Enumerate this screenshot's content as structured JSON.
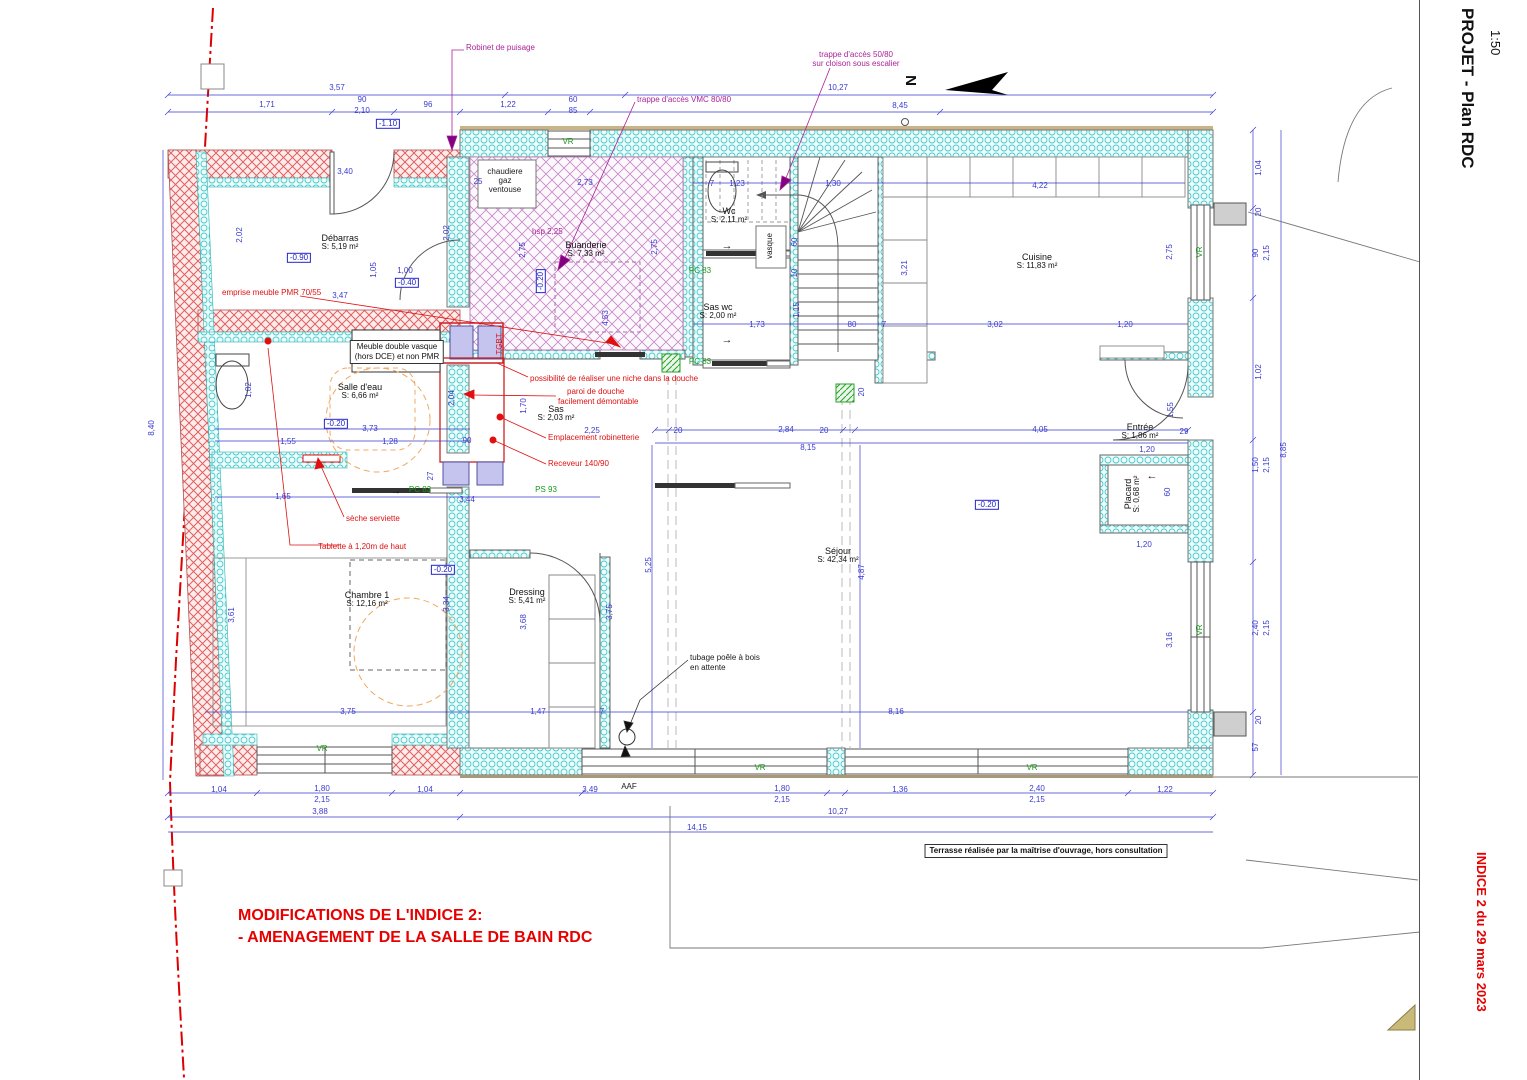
{
  "meta": {
    "title": "PROJET - Plan RDC",
    "scale": "1:50",
    "revision": "INDICE 2 du 29 mars 2023",
    "north": "N"
  },
  "notes": {
    "modif1": "MODIFICATIONS DE L'INDICE 2:",
    "modif2": "- AMENAGEMENT DE LA SALLE DE BAIN RDC",
    "terrasse": "Terrasse réalisée par la maîtrise d'ouvrage, hors consultation",
    "meuble1": "Meuble double vasque",
    "meuble2": "(hors DCE) et non PMR"
  },
  "rooms": [
    {
      "name": "Débarras",
      "area": "S: 5,19 m²",
      "x": 340,
      "y": 243
    },
    {
      "name": "Buanderie",
      "area": "S: 7,33 m²",
      "x": 586,
      "y": 250
    },
    {
      "name": "Wc",
      "area": "S: 2,11 m²",
      "x": 729,
      "y": 216
    },
    {
      "name": "Sas wc",
      "area": "S: 2,00 m²",
      "x": 718,
      "y": 312
    },
    {
      "name": "Cuisine",
      "area": "S: 11,83 m²",
      "x": 1037,
      "y": 262
    },
    {
      "name": "Salle d'eau",
      "area": "S: 6,66 m²",
      "x": 360,
      "y": 392
    },
    {
      "name": "Sas",
      "area": "S: 2,03 m²",
      "x": 556,
      "y": 414
    },
    {
      "name": "Entrée",
      "area": "S: 1,86 m²",
      "x": 1140,
      "y": 432
    },
    {
      "name": "Placard",
      "area": "S: 0,68 m²",
      "x": 1133,
      "y": 494,
      "v": 1
    },
    {
      "name": "Chambre 1",
      "area": "S: 12,16 m²",
      "x": 367,
      "y": 600
    },
    {
      "name": "Dressing",
      "area": "S: 5,41 m²",
      "x": 527,
      "y": 597
    },
    {
      "name": "Séjour",
      "area": "S: 42,34 m²",
      "x": 838,
      "y": 556
    }
  ],
  "levels": [
    {
      "t": "-1.10",
      "x": 388,
      "y": 124
    },
    {
      "t": "-0.90",
      "x": 299,
      "y": 258
    },
    {
      "t": "-0.40",
      "x": 407,
      "y": 283
    },
    {
      "t": "-0.20",
      "x": 541,
      "y": 281,
      "v": 1
    },
    {
      "t": "-0.20",
      "x": 336,
      "y": 424
    },
    {
      "t": "-0.20",
      "x": 443,
      "y": 570
    },
    {
      "t": "-0.20",
      "x": 987,
      "y": 505
    }
  ],
  "openings": [
    {
      "t": "VR",
      "x": 568,
      "y": 142
    },
    {
      "t": "VR",
      "x": 1200,
      "y": 252,
      "v": 1
    },
    {
      "t": "VR",
      "x": 1200,
      "y": 630,
      "v": 1
    },
    {
      "t": "VR",
      "x": 322,
      "y": 749
    },
    {
      "t": "VR",
      "x": 760,
      "y": 768
    },
    {
      "t": "VR",
      "x": 1032,
      "y": 768
    },
    {
      "t": "PC 83",
      "x": 700,
      "y": 271
    },
    {
      "t": "PC 83",
      "x": 700,
      "y": 362
    },
    {
      "t": "PC 83",
      "x": 420,
      "y": 490
    },
    {
      "t": "PS 93",
      "x": 546,
      "y": 490
    }
  ],
  "annotations": {
    "red": [
      {
        "t": "emprise meuble PMR 70/55",
        "x": 222,
        "y": 293,
        "anchor": "left"
      },
      {
        "t": "possibilité de réaliser une niche dans la douche",
        "x": 530,
        "y": 379,
        "anchor": "left"
      },
      {
        "t": "paroi de douche",
        "x": 567,
        "y": 392,
        "anchor": "left"
      },
      {
        "t": "facilement démontable",
        "x": 558,
        "y": 402,
        "anchor": "left"
      },
      {
        "t": "Emplacement robinetterie",
        "x": 548,
        "y": 438,
        "anchor": "left"
      },
      {
        "t": "Receveur 140/90",
        "x": 548,
        "y": 464,
        "anchor": "left"
      },
      {
        "t": "sèche serviette",
        "x": 346,
        "y": 519,
        "anchor": "left"
      },
      {
        "t": "Tablette à 1,20m de haut",
        "x": 318,
        "y": 547,
        "anchor": "left"
      },
      {
        "t": "TGBT",
        "x": 500,
        "y": 344,
        "v": 1
      }
    ],
    "magenta": [
      {
        "t": "Robinet de puisage",
        "x": 466,
        "y": 48,
        "anchor": "left"
      },
      {
        "t": "trappe d'accès VMC 80/80",
        "x": 637,
        "y": 100,
        "anchor": "left"
      },
      {
        "t": "trappe d'accès 50/80",
        "x": 856,
        "y": 55
      },
      {
        "t": "sur cloison sous escalier",
        "x": 856,
        "y": 64
      },
      {
        "t": "hsp 2,25",
        "x": 532,
        "y": 232,
        "anchor": "left"
      }
    ],
    "black": [
      {
        "t": "chaudiere",
        "x": 505,
        "y": 172
      },
      {
        "t": "gaz",
        "x": 505,
        "y": 181
      },
      {
        "t": "ventouse",
        "x": 505,
        "y": 190
      },
      {
        "t": "vasque",
        "x": 770,
        "y": 246,
        "v": 1
      },
      {
        "t": "tubage poêle à bois",
        "x": 690,
        "y": 658,
        "anchor": "left"
      },
      {
        "t": "en attente",
        "x": 690,
        "y": 668,
        "anchor": "left"
      },
      {
        "t": "AAF",
        "x": 629,
        "y": 787
      }
    ],
    "arrows": [
      {
        "t": "→",
        "x": 727,
        "y": 247
      },
      {
        "t": "→",
        "x": 727,
        "y": 341
      },
      {
        "t": "→",
        "x": 396,
        "y": 492
      },
      {
        "t": "←",
        "x": 1152,
        "y": 477
      }
    ]
  },
  "dims": [
    {
      "t": "3,57",
      "x": 337,
      "y": 88
    },
    {
      "t": "1,71",
      "x": 267,
      "y": 105
    },
    {
      "t": "90",
      "x": 362,
      "y": 100
    },
    {
      "t": "2,10",
      "x": 362,
      "y": 111
    },
    {
      "t": "96",
      "x": 428,
      "y": 105
    },
    {
      "t": "1,22",
      "x": 508,
      "y": 105
    },
    {
      "t": "60",
      "x": 573,
      "y": 100
    },
    {
      "t": "85",
      "x": 573,
      "y": 111
    },
    {
      "t": "10,27",
      "x": 838,
      "y": 88
    },
    {
      "t": "8,45",
      "x": 900,
      "y": 106
    },
    {
      "t": "25",
      "x": 478,
      "y": 182
    },
    {
      "t": "2,73",
      "x": 585,
      "y": 183
    },
    {
      "t": "3,40",
      "x": 345,
      "y": 172
    },
    {
      "t": "1,23",
      "x": 737,
      "y": 184
    },
    {
      "t": "7",
      "x": 712,
      "y": 184
    },
    {
      "t": "1,30",
      "x": 833,
      "y": 184
    },
    {
      "t": "4,22",
      "x": 1040,
      "y": 186
    },
    {
      "t": "1,04",
      "x": 1259,
      "y": 168,
      "v": 1
    },
    {
      "t": "20",
      "x": 1259,
      "y": 212,
      "v": 1
    },
    {
      "t": "2,02",
      "x": 240,
      "y": 235,
      "v": 1
    },
    {
      "t": "2,02",
      "x": 447,
      "y": 233,
      "v": 1
    },
    {
      "t": "2,75",
      "x": 523,
      "y": 250,
      "v": 1
    },
    {
      "t": "2,75",
      "x": 655,
      "y": 247,
      "v": 1
    },
    {
      "t": "2,75",
      "x": 1170,
      "y": 252,
      "v": 1
    },
    {
      "t": "90",
      "x": 1256,
      "y": 253,
      "v": 1
    },
    {
      "t": "2,15",
      "x": 1267,
      "y": 253,
      "v": 1
    },
    {
      "t": "1,05",
      "x": 374,
      "y": 270,
      "v": 1
    },
    {
      "t": "1,00",
      "x": 405,
      "y": 271
    },
    {
      "t": "3,47",
      "x": 340,
      "y": 296
    },
    {
      "t": "3,21",
      "x": 905,
      "y": 268,
      "v": 1
    },
    {
      "t": "4,53",
      "x": 606,
      "y": 318,
      "v": 1
    },
    {
      "t": "1,15",
      "x": 797,
      "y": 310,
      "v": 1
    },
    {
      "t": "60",
      "x": 795,
      "y": 242,
      "v": 1
    },
    {
      "t": "10",
      "x": 795,
      "y": 273,
      "v": 1
    },
    {
      "t": "1,73",
      "x": 757,
      "y": 325
    },
    {
      "t": "80",
      "x": 852,
      "y": 325
    },
    {
      "t": "7",
      "x": 884,
      "y": 325
    },
    {
      "t": "3,02",
      "x": 995,
      "y": 325
    },
    {
      "t": "1,20",
      "x": 1125,
      "y": 325
    },
    {
      "t": "1,02",
      "x": 1259,
      "y": 372,
      "v": 1
    },
    {
      "t": "1,82",
      "x": 249,
      "y": 390,
      "v": 1
    },
    {
      "t": "2,04",
      "x": 452,
      "y": 398,
      "v": 1
    },
    {
      "t": "1,70",
      "x": 524,
      "y": 406,
      "v": 1
    },
    {
      "t": "2,25",
      "x": 592,
      "y": 431
    },
    {
      "t": "3,73",
      "x": 370,
      "y": 429
    },
    {
      "t": "1,28",
      "x": 390,
      "y": 442
    },
    {
      "t": "1,55",
      "x": 288,
      "y": 442
    },
    {
      "t": "90",
      "x": 467,
      "y": 441
    },
    {
      "t": "2,84",
      "x": 786,
      "y": 430
    },
    {
      "t": "20",
      "x": 678,
      "y": 431
    },
    {
      "t": "20",
      "x": 824,
      "y": 431
    },
    {
      "t": "4,05",
      "x": 1040,
      "y": 430
    },
    {
      "t": "8,15",
      "x": 808,
      "y": 448
    },
    {
      "t": "1,55",
      "x": 1171,
      "y": 410,
      "v": 1
    },
    {
      "t": "29",
      "x": 1184,
      "y": 432
    },
    {
      "t": "1,20",
      "x": 1147,
      "y": 450
    },
    {
      "t": "60",
      "x": 1168,
      "y": 492,
      "v": 1
    },
    {
      "t": "1,20",
      "x": 1144,
      "y": 545
    },
    {
      "t": "1,50",
      "x": 1256,
      "y": 465,
      "v": 1
    },
    {
      "t": "2,15",
      "x": 1267,
      "y": 465,
      "v": 1
    },
    {
      "t": "8,85",
      "x": 1284,
      "y": 450,
      "v": 1
    },
    {
      "t": "8,40",
      "x": 152,
      "y": 428,
      "v": 1
    },
    {
      "t": "1,65",
      "x": 283,
      "y": 497
    },
    {
      "t": "27",
      "x": 431,
      "y": 476,
      "v": 1
    },
    {
      "t": "3,44",
      "x": 467,
      "y": 500
    },
    {
      "t": "5,25",
      "x": 649,
      "y": 565,
      "v": 1
    },
    {
      "t": "4,87",
      "x": 862,
      "y": 572,
      "v": 1
    },
    {
      "t": "3,61",
      "x": 232,
      "y": 615,
      "v": 1
    },
    {
      "t": "3,34",
      "x": 447,
      "y": 604,
      "v": 1
    },
    {
      "t": "3,68",
      "x": 524,
      "y": 622,
      "v": 1
    },
    {
      "t": "3,75",
      "x": 610,
      "y": 612,
      "v": 1
    },
    {
      "t": "3,16",
      "x": 1170,
      "y": 640,
      "v": 1
    },
    {
      "t": "20",
      "x": 862,
      "y": 392,
      "v": 1
    },
    {
      "t": "2,40",
      "x": 1256,
      "y": 628,
      "v": 1
    },
    {
      "t": "2,15",
      "x": 1267,
      "y": 628,
      "v": 1
    },
    {
      "t": "3,75",
      "x": 348,
      "y": 712
    },
    {
      "t": "1,47",
      "x": 538,
      "y": 712
    },
    {
      "t": "7",
      "x": 602,
      "y": 712
    },
    {
      "t": "8,16",
      "x": 896,
      "y": 712
    },
    {
      "t": "20",
      "x": 1259,
      "y": 720,
      "v": 1
    },
    {
      "t": "57",
      "x": 1256,
      "y": 747,
      "v": 1
    },
    {
      "t": "1,04",
      "x": 219,
      "y": 790
    },
    {
      "t": "1,80",
      "x": 322,
      "y": 789
    },
    {
      "t": "2,15",
      "x": 322,
      "y": 800
    },
    {
      "t": "1,04",
      "x": 425,
      "y": 790
    },
    {
      "t": "3,49",
      "x": 590,
      "y": 790
    },
    {
      "t": "1,80",
      "x": 782,
      "y": 789
    },
    {
      "t": "2,15",
      "x": 782,
      "y": 800
    },
    {
      "t": "1,36",
      "x": 900,
      "y": 790
    },
    {
      "t": "2,40",
      "x": 1037,
      "y": 789
    },
    {
      "t": "2,15",
      "x": 1037,
      "y": 800
    },
    {
      "t": "1,22",
      "x": 1165,
      "y": 790
    },
    {
      "t": "3,88",
      "x": 320,
      "y": 812
    },
    {
      "t": "10,27",
      "x": 838,
      "y": 812
    },
    {
      "t": "14,15",
      "x": 697,
      "y": 828
    }
  ]
}
